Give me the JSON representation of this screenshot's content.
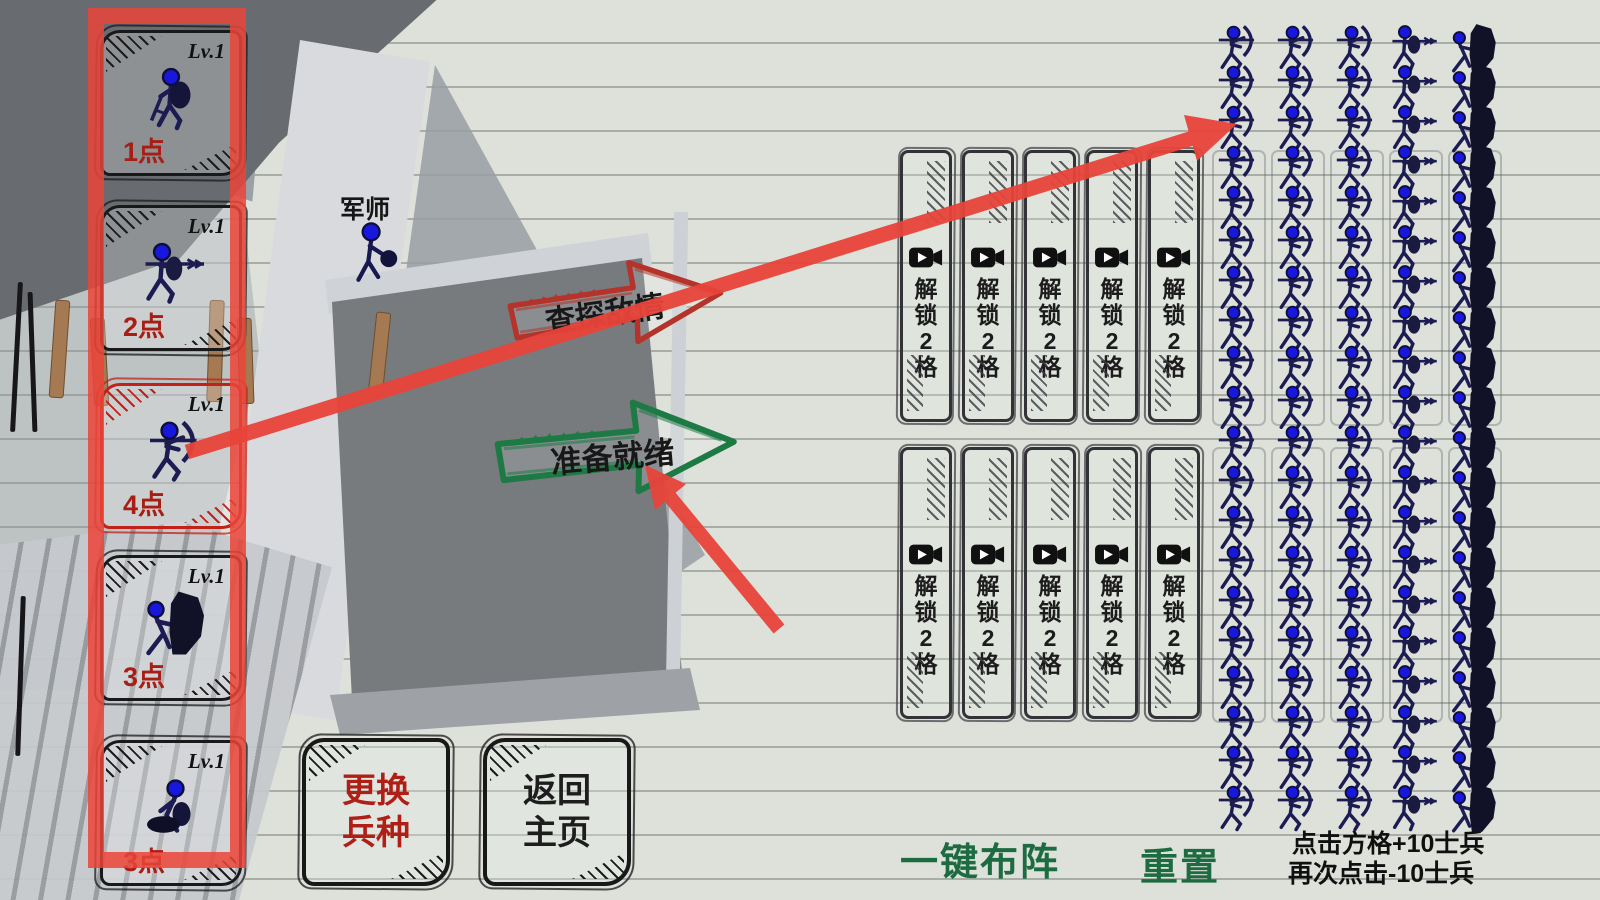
{
  "unit_panel": {
    "cards": [
      {
        "level": "Lv.1",
        "cost": "1点",
        "unit": "swordsman",
        "selected": false
      },
      {
        "level": "Lv.1",
        "cost": "2点",
        "unit": "spearman",
        "selected": false
      },
      {
        "level": "Lv.1",
        "cost": "4点",
        "unit": "archer",
        "selected": true
      },
      {
        "level": "Lv.1",
        "cost": "3点",
        "unit": "shieldman",
        "selected": false
      },
      {
        "level": "Lv.1",
        "cost": "3点",
        "unit": "crossbowman",
        "selected": false
      }
    ]
  },
  "advisor": {
    "label": "军师"
  },
  "actions": {
    "view_enemy": {
      "label": "查探敌情"
    },
    "ready": {
      "label": "准备就绪"
    }
  },
  "unlock": {
    "label": "解锁2格",
    "count": 10
  },
  "army": {
    "rows": 20,
    "columns": [
      {
        "type": "archer"
      },
      {
        "type": "archer"
      },
      {
        "type": "archer"
      },
      {
        "type": "spearman"
      },
      {
        "type": "shieldman"
      }
    ]
  },
  "footer": {
    "change_units": "更换兵种",
    "back_home": "返回主页",
    "auto_formation": "一键布阵",
    "reset": "重置",
    "hint_plus": "点击方格+10士兵",
    "hint_minus": "再次点击-10士兵"
  },
  "colors": {
    "tutorial_red": "#e8443a",
    "selected_red": "#c2211a",
    "cost_red": "#a81d14",
    "action_red": "#b5332a",
    "action_green": "#1e7a45",
    "footer_green": "#1d6b40",
    "unit_navy": "#1c1c52",
    "head_blue": "#1717dd"
  }
}
